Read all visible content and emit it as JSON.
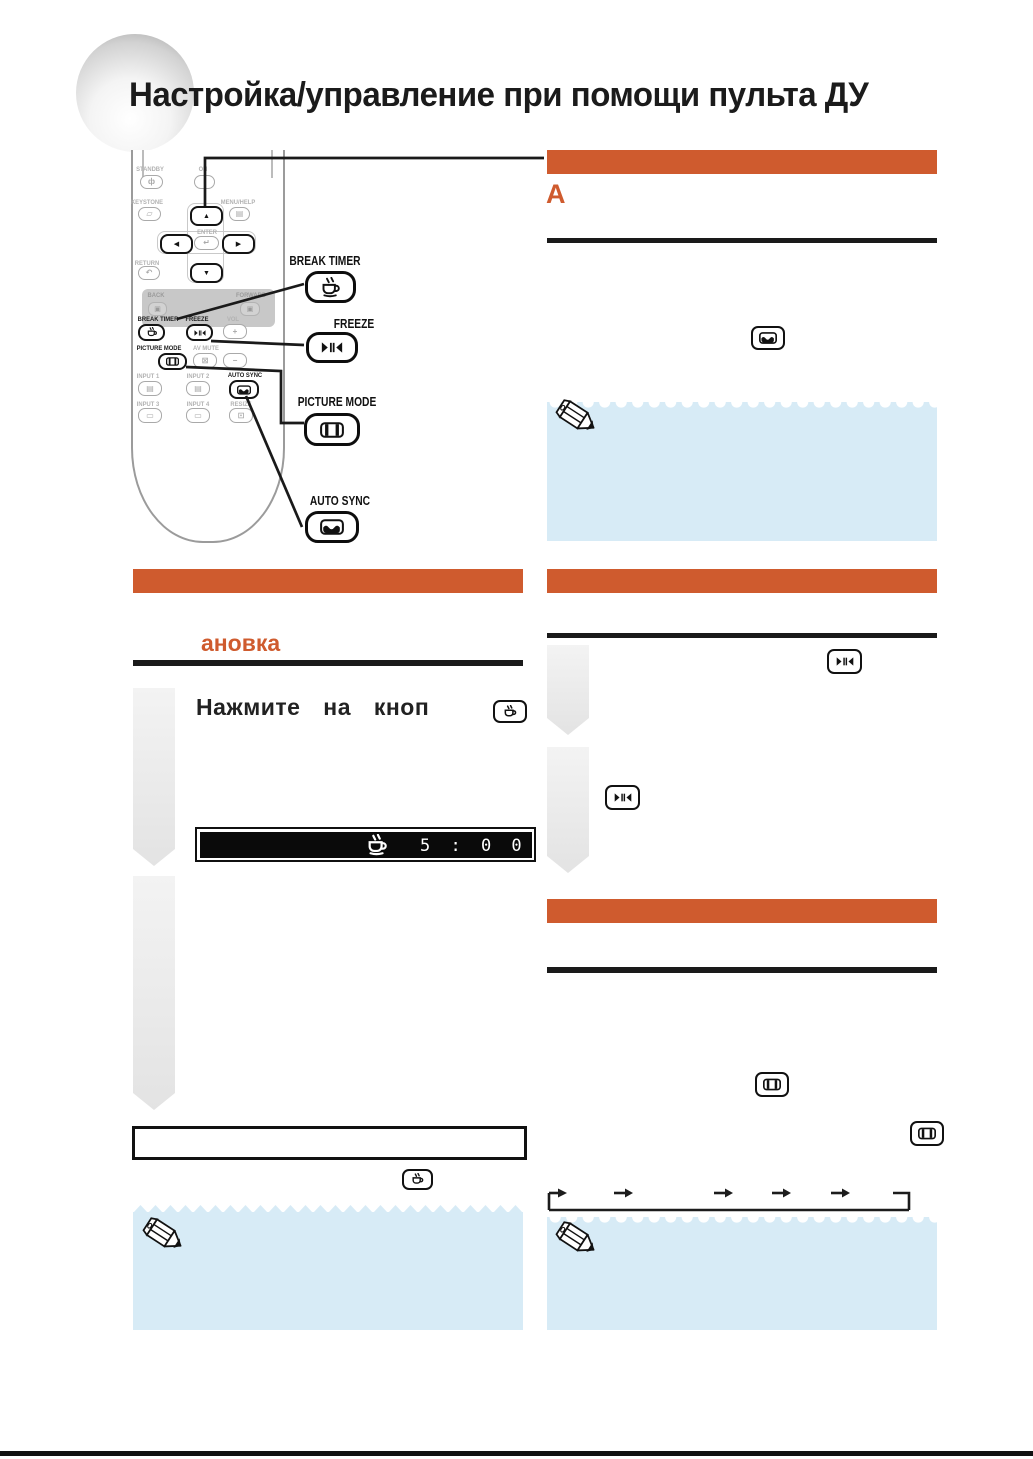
{
  "page": {
    "title": "Настройка/управление при помощи пульта ДУ"
  },
  "colors": {
    "accent": "#cf5b2e",
    "note_bg": "#d7ebf6",
    "line": "#1a1a1a"
  },
  "remote": {
    "standby": "STANDBY",
    "on": "ON",
    "keystone": "KEYSTONE",
    "menu_help": "MENU/HELP",
    "enter": "ENTER",
    "return": "RETURN",
    "back": "BACK",
    "forward": "FORWARD",
    "break_timer": "BREAK TIMER",
    "freeze": "FREEZE",
    "vol": "VOL",
    "picture_mode": "PICTURE MODE",
    "av_mute": "AV MUTE",
    "input1": "INPUT 1",
    "input2": "INPUT 2",
    "auto_sync": "AUTO SYNC",
    "input3": "INPUT 3",
    "input4": "INPUT 4",
    "resize": "RESIZE",
    "glyphs": {
      "standby": "ф",
      "on": "I",
      "keystone": "▱",
      "menu_help": "▤",
      "enter": "↵",
      "return": "↶",
      "back": "▣",
      "forward": "▣",
      "vol_plus": "+",
      "vol_minus": "−",
      "av_mute": "⊠",
      "input1": "▤",
      "input2": "▤",
      "input3": "▭",
      "input4": "▭",
      "resize": "⊡",
      "up": "▲",
      "down": "▼",
      "left": "◀",
      "right": "▶"
    }
  },
  "callouts": {
    "break_timer": "BREAK TIMER",
    "freeze": "FREEZE",
    "picture_mode": "PICTURE MODE",
    "auto_sync": "AUTO SYNC"
  },
  "sections": {
    "right_top": {
      "label": "A"
    },
    "left": {
      "heading_fragment": "ановка",
      "step1_text": "Нажмите на кноп",
      "timer_value": "5 : 0 0"
    }
  },
  "icons": {
    "break_timer": "coffee-cup",
    "freeze": "freeze-frame",
    "picture_mode": "film-frame",
    "auto_sync": "sync-wave",
    "note": "pencil"
  }
}
